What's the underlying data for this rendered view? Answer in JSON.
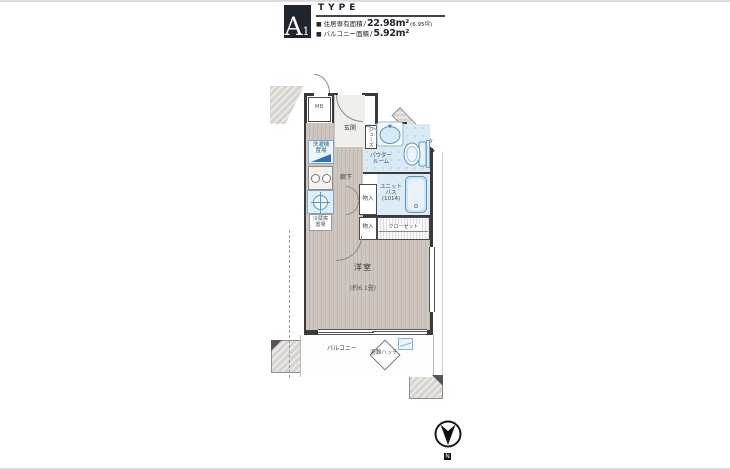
{
  "header": {
    "unit_letter": "A",
    "unit_number": "1",
    "type_label": "TYPE",
    "area_lines": [
      {
        "bullet": "■",
        "label": "住居専有面積",
        "sep": "/",
        "value": "22.98m²",
        "note": "(6.95坪)"
      },
      {
        "bullet": "■",
        "label": "バルコニー面積",
        "sep": "/",
        "value": "5.92m²",
        "note": ""
      }
    ]
  },
  "plan": {
    "rooms": {
      "entrance": "玄関",
      "hallway": "廊下",
      "powder_room_l1": "パウダー",
      "powder_room_l2": "ルーム",
      "unit_bath_l1": "ユニット",
      "unit_bath_l2": "バス",
      "unit_bath_l3": "(1014)",
      "western_room": "洋室",
      "western_room_size": "(約6.1畳)",
      "balcony": "バルコニー",
      "closet": "クローゼット",
      "storage_upper": "物入",
      "storage_lower": "物入",
      "shoe_closet": "シューズ",
      "meter_box": "MB"
    },
    "fixtures": {
      "washer_l1": "洗濯機",
      "washer_l2": "置場",
      "fridge_l1": "冷蔵庫",
      "fridge_l2": "置場",
      "evacuation_hatch": "避難ハッチ"
    },
    "compass_label": "N"
  },
  "colors": {
    "wall": "#3a3a3a",
    "wood_floor": "#cbc1ba",
    "water_area": "#d9eaf4",
    "fixture_blue": "#5b94bd",
    "outside_gray": "#d8d4d0",
    "header_navy": "#20242f"
  }
}
